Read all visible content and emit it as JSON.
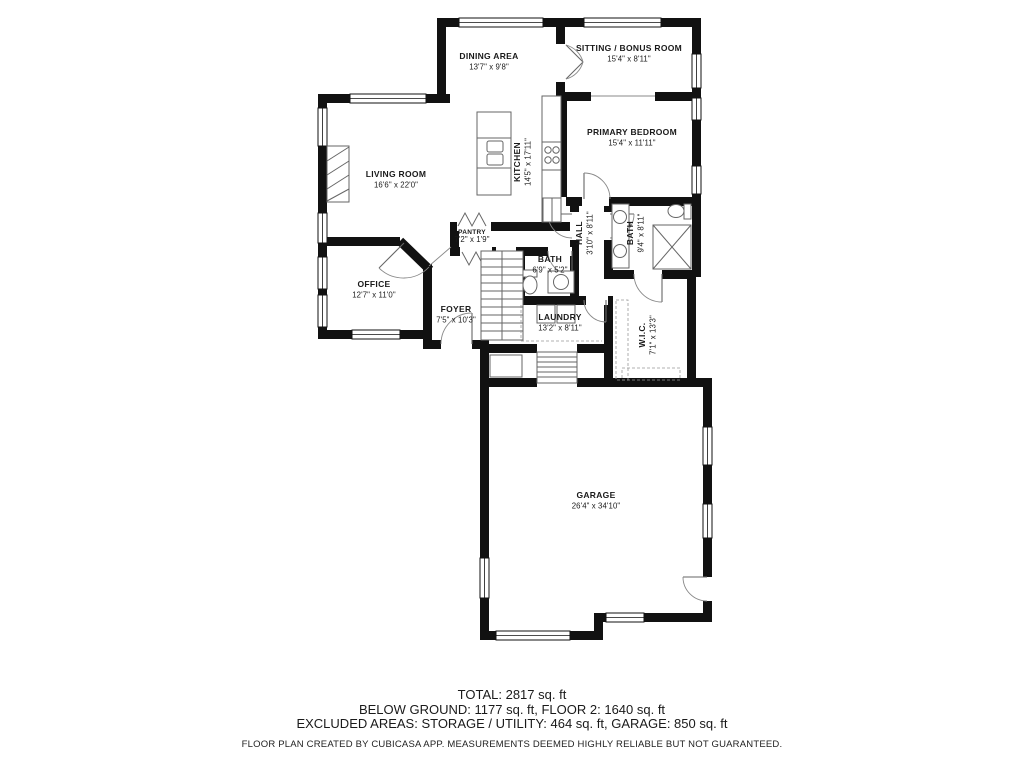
{
  "plan": {
    "rooms": [
      {
        "id": "dining-area",
        "name": "DINING AREA",
        "dims": "13'7\" x 9'8\"",
        "x": 489,
        "y": 59
      },
      {
        "id": "sitting-bonus-room",
        "name": "SITTING / BONUS ROOM",
        "dims": "15'4\" x 8'11\"",
        "x": 629,
        "y": 51
      },
      {
        "id": "primary-bedroom",
        "name": "PRIMARY BEDROOM",
        "dims": "15'4\" x 11'11\"",
        "x": 632,
        "y": 135
      },
      {
        "id": "living-room",
        "name": "LIVING ROOM",
        "dims": "16'6\" x 22'0\"",
        "x": 396,
        "y": 177
      },
      {
        "id": "kitchen",
        "name": "KITCHEN",
        "dims": "14'5\" x 17'11\"",
        "x": 520,
        "y": 162,
        "rotate": -90
      },
      {
        "id": "pantry",
        "name": "PANTRY",
        "dims": "7'2\" x 1'9\"",
        "x": 472,
        "y": 234,
        "size": 6.5
      },
      {
        "id": "office",
        "name": "OFFICE",
        "dims": "12'7\" x 11'0\"",
        "x": 374,
        "y": 287
      },
      {
        "id": "foyer",
        "name": "FOYER",
        "dims": "7'5\" x 10'3\"",
        "x": 456,
        "y": 312
      },
      {
        "id": "bath-small",
        "name": "BATH",
        "dims": "6'9\" x 5'2\"",
        "x": 550,
        "y": 262
      },
      {
        "id": "hall",
        "name": "HALL",
        "dims": "3'10\" x 8'11\"",
        "x": 582,
        "y": 233,
        "rotate": -90
      },
      {
        "id": "bath-primary",
        "name": "BATH",
        "dims": "9'4\" x 8'11\"",
        "x": 633,
        "y": 233,
        "rotate": -90
      },
      {
        "id": "laundry",
        "name": "LAUNDRY",
        "dims": "13'2\" x 8'11\"",
        "x": 560,
        "y": 320
      },
      {
        "id": "wic",
        "name": "W.I.C.",
        "dims": "7'1\" x 13'3\"",
        "x": 645,
        "y": 335,
        "rotate": -90
      },
      {
        "id": "garage",
        "name": "GARAGE",
        "dims": "26'4\" x 34'10\"",
        "x": 596,
        "y": 498
      }
    ]
  },
  "footer": {
    "line1": "TOTAL: 2817 sq. ft",
    "line2": "BELOW GROUND: 1177 sq. ft, FLOOR 2: 1640 sq. ft",
    "line3": "EXCLUDED AREAS: STORAGE / UTILITY: 464 sq. ft, GARAGE: 850 sq. ft",
    "disclaimer": "FLOOR PLAN CREATED BY CUBICASA APP. MEASUREMENTS DEEMED HIGHLY RELIABLE BUT NOT GUARANTEED."
  },
  "colors": {
    "walls": "#111111",
    "background": "#ffffff",
    "thin_lines": "#666666"
  }
}
